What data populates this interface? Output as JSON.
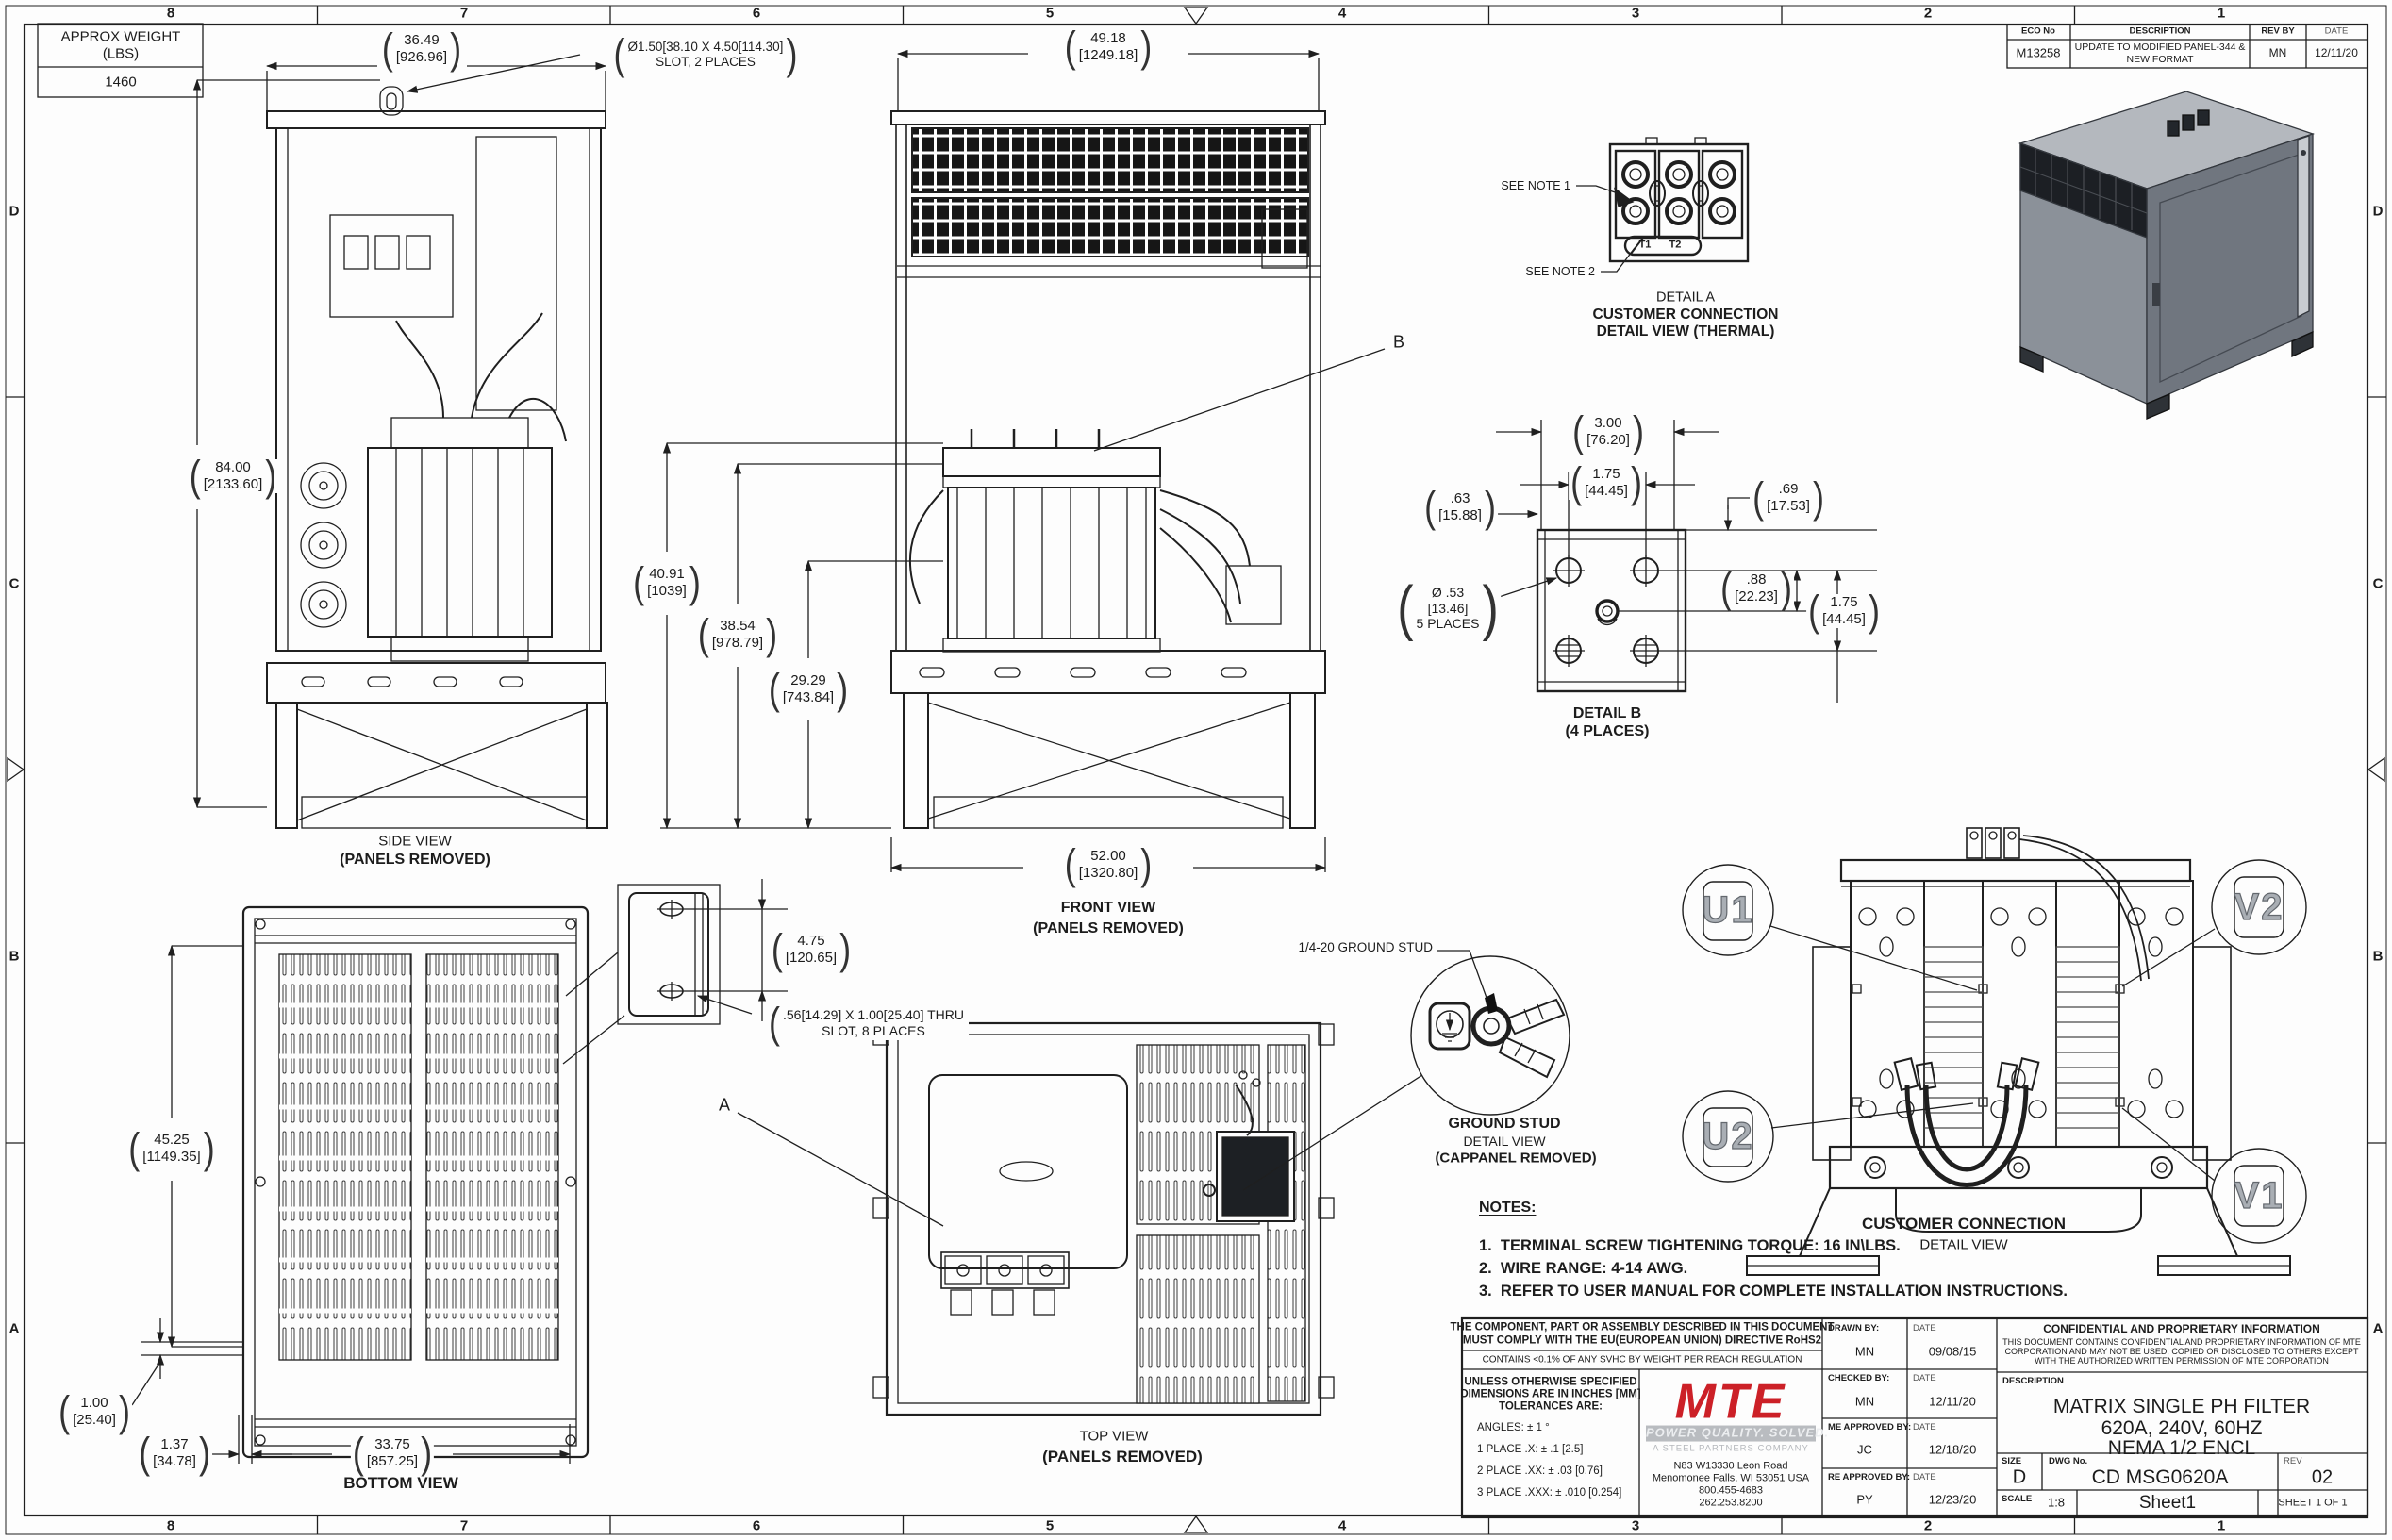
{
  "sheet": {
    "zones_h": [
      "8",
      "7",
      "6",
      "5",
      "4",
      "3",
      "2",
      "1"
    ],
    "zones_v": [
      "D",
      "C",
      "B",
      "A"
    ]
  },
  "colors": {
    "line": "#1f1f1f",
    "logo_red": "#cc2027",
    "iso_top": "#b4b8be",
    "iso_left": "#8b9199",
    "iso_right": "#70767f",
    "iso_vent": "#1c1f24"
  },
  "weight_table": {
    "title_line1": "APPROX WEIGHT",
    "title_line2": "(LBS)",
    "value": "1460"
  },
  "eco_table": {
    "headers": [
      "ECO No",
      "DESCRIPTION",
      "REV BY",
      "DATE"
    ],
    "row": {
      "eco_no": "M13258",
      "description_line1": "UPDATE TO MODIFIED PANEL-344 &",
      "description_line2": "NEW FORMAT",
      "rev_by": "MN",
      "date": "12/11/20"
    }
  },
  "views": {
    "side": {
      "title": "SIDE VIEW",
      "subtitle": "(PANELS REMOVED)"
    },
    "front": {
      "title": "FRONT VIEW",
      "subtitle": "(PANELS REMOVED)"
    },
    "top": {
      "title": "TOP VIEW",
      "subtitle": "(PANELS REMOVED)"
    },
    "bottom": {
      "title": "BOTTOM VIEW"
    },
    "detail_a": {
      "line1": "DETAIL A",
      "line2": "CUSTOMER CONNECTION",
      "line3": "DETAIL VIEW (THERMAL)",
      "see_note_1": "SEE NOTE 1",
      "see_note_2": "SEE NOTE 2",
      "t1": "T1",
      "t2": "T2"
    },
    "detail_b": {
      "line1": "DETAIL B",
      "line2": "(4 PLACES)"
    },
    "ground_stud": {
      "callout": "1/4-20 GROUND STUD",
      "line1": "GROUND STUD",
      "line2": "DETAIL VIEW",
      "line3": "(CAPPANEL REMOVED)"
    },
    "customer_connection": {
      "line1": "CUSTOMER CONNECTION",
      "line2": "DETAIL VIEW",
      "balloon_u1": "U1",
      "balloon_v2": "V2",
      "balloon_u2": "U2",
      "balloon_v1": "V1"
    }
  },
  "dims": {
    "side_width": {
      "in": "36.49",
      "mm": "[926.96]"
    },
    "side_height": {
      "in": "84.00",
      "mm": "[2133.60]"
    },
    "slot_note": {
      "line1": "Ø1.50[38.10 X 4.50[114.30]",
      "line2": "SLOT, 2 PLACES"
    },
    "front_width_top": {
      "in": "49.18",
      "mm": "[1249.18]"
    },
    "front_h1": {
      "in": "40.91",
      "mm": "[1039]"
    },
    "front_h2": {
      "in": "38.54",
      "mm": "[978.79]"
    },
    "front_h3": {
      "in": "29.29",
      "mm": "[743.84]"
    },
    "front_width_bottom": {
      "in": "52.00",
      "mm": "[1320.80]"
    },
    "detail_b_w1": {
      "in": "3.00",
      "mm": "[76.20]"
    },
    "detail_b_w2": {
      "in": "1.75",
      "mm": "[44.45]"
    },
    "detail_b_left": {
      "in": ".63",
      "mm": "[15.88]"
    },
    "detail_b_right1": {
      "in": ".69",
      "mm": "[17.53]"
    },
    "detail_b_right2": {
      "in": ".88",
      "mm": "[22.23]"
    },
    "detail_b_right3": {
      "in": "1.75",
      "mm": "[44.45]"
    },
    "detail_b_dia": {
      "line1": "Ø .53",
      "line2": "[13.46]",
      "line3": "5 PLACES"
    },
    "bottom_height": {
      "in": "45.25",
      "mm": "[1149.35]"
    },
    "bottom_off1": {
      "in": "1.00",
      "mm": "[25.40]"
    },
    "bottom_off2": {
      "in": "1.37",
      "mm": "[34.78]"
    },
    "bottom_width": {
      "in": "33.75",
      "mm": "[857.25]"
    },
    "bracket_pitch": {
      "in": "4.75",
      "mm": "[120.65]"
    },
    "bracket_slot": {
      "line1": ".56[14.29] X 1.00[25.40] THRU",
      "line2": "SLOT, 8 PLACES"
    },
    "pointer_a": "A",
    "pointer_b": "B"
  },
  "notes": {
    "heading": "NOTES:",
    "item1": "1.  TERMINAL SCREW TIGHTENING TORQUE: 16 IN\\LBS.",
    "item2": "2.  WIRE RANGE: 4-14 AWG.",
    "item3": "3.  REFER TO USER MANUAL FOR COMPLETE INSTALLATION INSTRUCTIONS."
  },
  "title_block": {
    "rohs_line1": "THE COMPONENT, PART OR ASSEMBLY DESCRIBED IN THIS DOCUMENT",
    "rohs_line2": "MUST COMPLY WITH THE EU(EUROPEAN UNION) DIRECTIVE RoHS2",
    "reach": "CONTAINS <0.1% OF ANY SVHC BY WEIGHT PER REACH REGULATION",
    "tol_head1": "UNLESS OTHERWISE SPECIFIED",
    "tol_head2": "DIMENSIONS ARE IN INCHES [MM]",
    "tol_head3": "TOLERANCES ARE:",
    "tol_angles": "ANGLES: ± 1 °",
    "tol_1": "1 PLACE .X: ± .1 [2.5]",
    "tol_2": "2 PLACE .XX: ± .03 [0.76]",
    "tol_3": "3 PLACE .XXX: ± .010 [0.254]",
    "logo_text": "MTE",
    "logo_tagline": "POWER QUALITY. SOLVED.",
    "logo_sub": "A STEEL PARTNERS COMPANY",
    "addr1": "N83 W13330 Leon Road",
    "addr2": "Menomonee Falls, WI 53051 USA",
    "addr3": "800.455-4683",
    "addr4": "262.253.8200",
    "drawn_label": "DRAWN BY:",
    "drawn_by": "MN",
    "drawn_date": "09/08/15",
    "checked_label": "CHECKED BY:",
    "checked_by": "MN",
    "checked_date": "12/11/20",
    "me_label": "ME APPROVED BY:",
    "me_by": "JC",
    "me_date": "12/18/20",
    "re_label": "RE APPROVED BY:",
    "re_by": "PY",
    "re_date": "12/23/20",
    "date_label": "DATE",
    "conf_head": "CONFIDENTIAL AND PROPRIETARY INFORMATION",
    "conf_body1": "THIS DOCUMENT CONTAINS CONFIDENTIAL AND PROPRIETARY INFORMATION OF MTE",
    "conf_body2": "CORPORATION AND MAY NOT BE USED, COPIED OR DISCLOSED TO OTHERS EXCEPT",
    "conf_body3": "WITH THE AUTHORIZED WRITTEN PERMISSION OF MTE CORPORATION",
    "desc_label": "DESCRIPTION",
    "desc1": "MATRIX SINGLE PH FILTER",
    "desc2": "620A, 240V, 60HZ",
    "desc3": "NEMA 1/2 ENCL",
    "size_label": "SIZE",
    "size": "D",
    "dwg_label": "DWG No.",
    "dwg_no": "CD MSG0620A",
    "rev_label": "REV",
    "rev": "02",
    "scale_label": "SCALE",
    "scale": "1:8",
    "sheet_name": "Sheet1",
    "sheet_of": "SHEET 1 OF 1"
  }
}
